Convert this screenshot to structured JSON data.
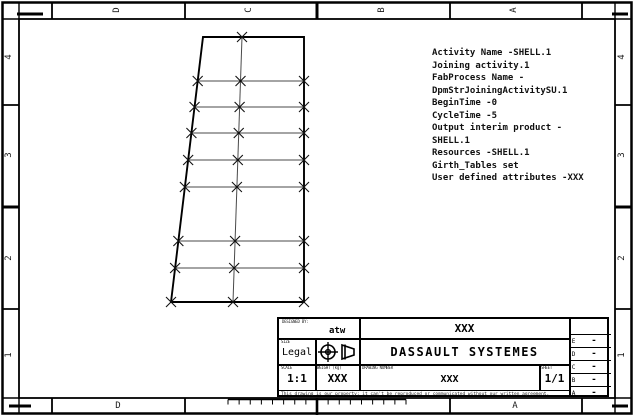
{
  "colors": {
    "line": "#000000",
    "mesh_line": "#4a4a4a",
    "marker": "#111111"
  },
  "zones": {
    "top": [
      "D",
      "C",
      "B",
      "A"
    ],
    "bottom": [
      "D",
      "A"
    ],
    "left": [
      "4",
      "3",
      "2",
      "1"
    ],
    "right": [
      "4",
      "3",
      "2",
      "1"
    ]
  },
  "annotation": {
    "lines": [
      "Activity Name -SHELL.1",
      "Joining activity.1",
      "FabProcess Name -",
      "DpmStrJoiningActivitySU.1",
      "BeginTime -0",
      "CycleTime -5",
      "Output interim product -",
      "SHELL.1",
      "Resources -SHELL.1",
      "Girth_Tables set",
      "User defined attributes -XXX"
    ]
  },
  "title_block": {
    "designed_by_label": "DESIGNED BY:",
    "designed_by": "atw",
    "top_title": "XXX",
    "size_label": "SIZE",
    "size": "Legal",
    "projection_icon": "first-angle-projection",
    "company": "DASSAULT SYSTEMES",
    "scale_label": "SCALE",
    "scale": "1:1",
    "weight_label": "WEIGHT (kg)",
    "weight": "XXX",
    "drawing_number_label": "DRAWING NUMBER",
    "drawing_number": "XXX",
    "sheet_label": "SHEET",
    "sheet": "1/1",
    "notice": "This drawing is our property; it can't be reproduced or communicated without our written agreement.",
    "revisions": [
      {
        "rev": "E",
        "value": "-"
      },
      {
        "rev": "D",
        "value": "-"
      },
      {
        "rev": "C",
        "value": "-"
      },
      {
        "rev": "B",
        "value": "-"
      },
      {
        "rev": "A",
        "value": "-"
      }
    ]
  },
  "drawing": {
    "outline": [
      [
        203,
        37
      ],
      [
        304,
        37
      ],
      [
        304,
        302
      ],
      [
        171,
        302
      ]
    ],
    "row_ys": [
      81,
      107,
      133,
      160,
      187,
      241,
      268
    ],
    "left_edge": {
      "top": [
        203,
        37
      ],
      "bottom": [
        171,
        302
      ]
    },
    "right_x": 304,
    "center_line": {
      "top": [
        242,
        37
      ],
      "bottom": [
        233,
        302
      ]
    },
    "marker_size": 5
  }
}
